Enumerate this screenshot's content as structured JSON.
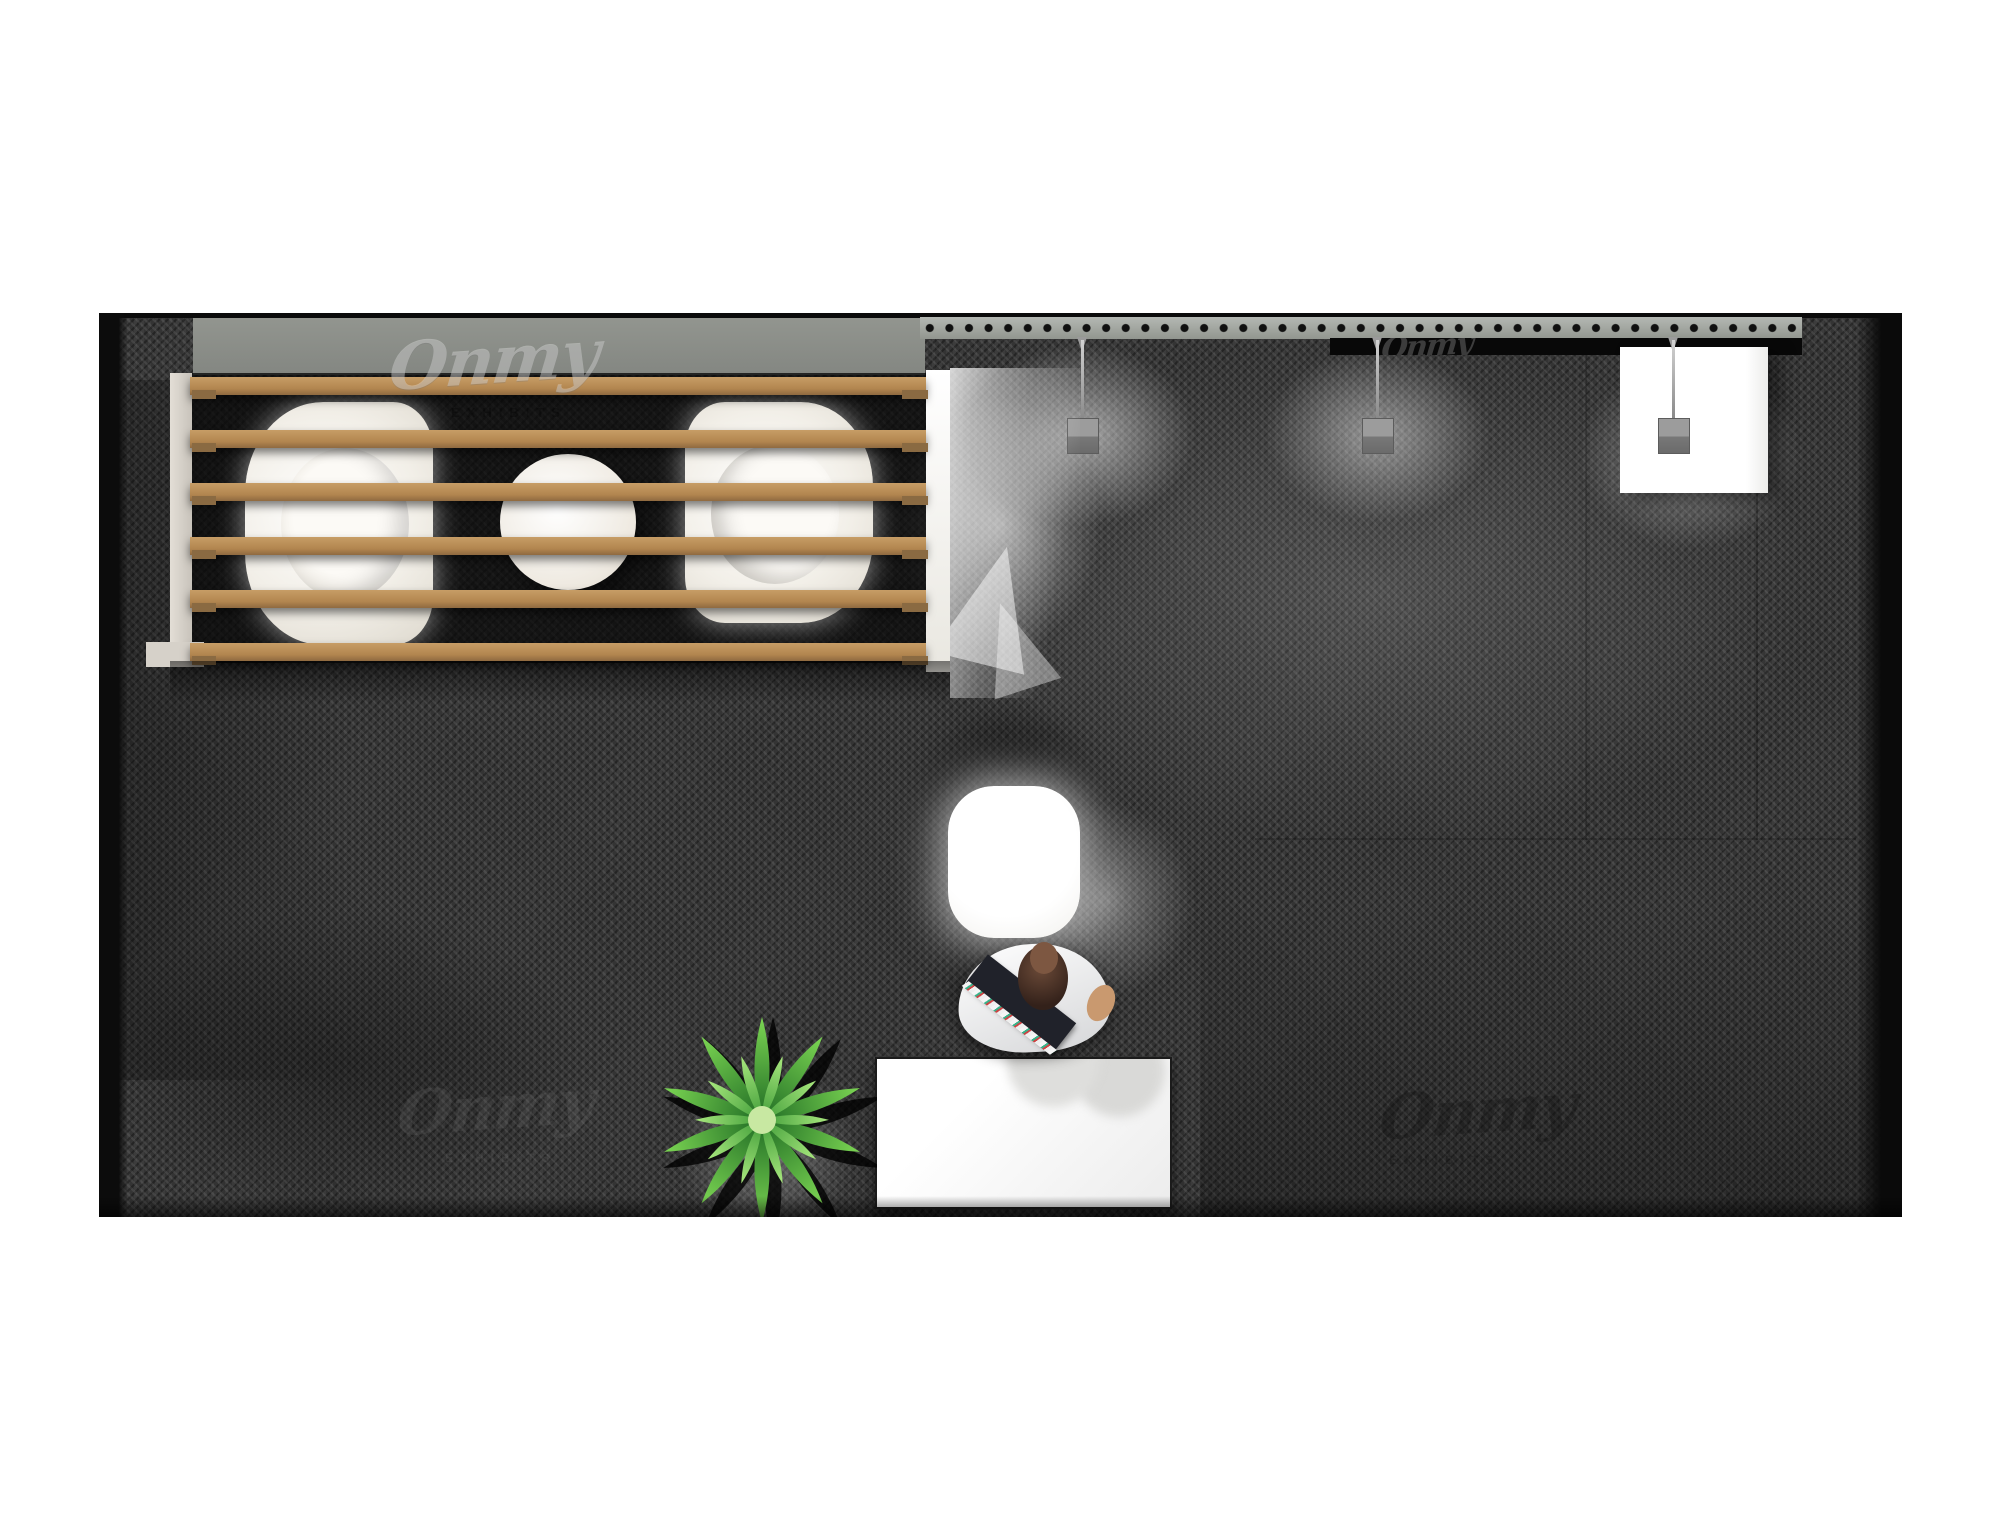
{
  "scene": {
    "description": "top view 3d render of a trade show exhibition booth",
    "watermark": {
      "script": "Onmy",
      "subtext": "EXHIBITS"
    },
    "counts": {
      "hanging_lamps": 3,
      "pergola_slats": 6,
      "armchairs": 2
    },
    "palette": {
      "background": "#ffffff",
      "carpet": "#343434",
      "carpet_shadow": "#0d0d0d",
      "wood_slat": "#b2854f",
      "wall_gray": "#8b8e8a",
      "truss_gray": "#a4a8a3",
      "black_strip": "#080808",
      "furniture_white": "#f4f2ec",
      "leaf_green": "#49b53f",
      "skin": "#c9996f",
      "hair_brown": "#45301f"
    }
  }
}
